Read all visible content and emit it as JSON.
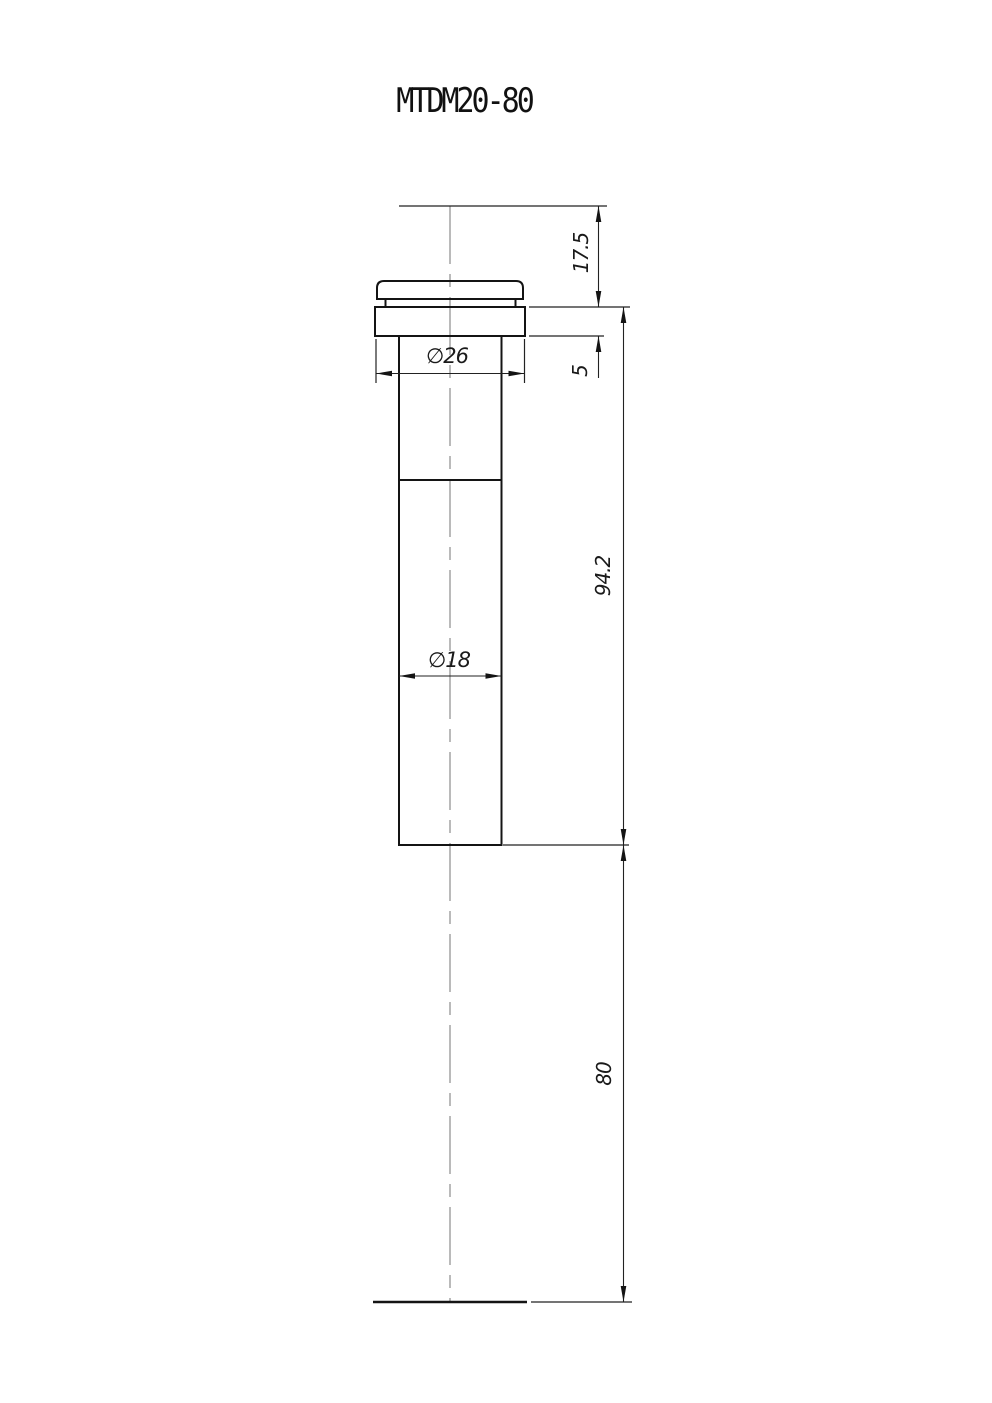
{
  "title": "MTDM20-80",
  "dimensions": {
    "top_height": "17.5",
    "flange_thickness": "5",
    "flange_diameter": "∅26",
    "body_diameter": "∅18",
    "body_length": "94.2",
    "working_distance": "80"
  },
  "colors": {
    "background": "#ffffff",
    "outline": "#141414",
    "dimension_lines": "#222222",
    "centerline": "#8c8c8c"
  }
}
